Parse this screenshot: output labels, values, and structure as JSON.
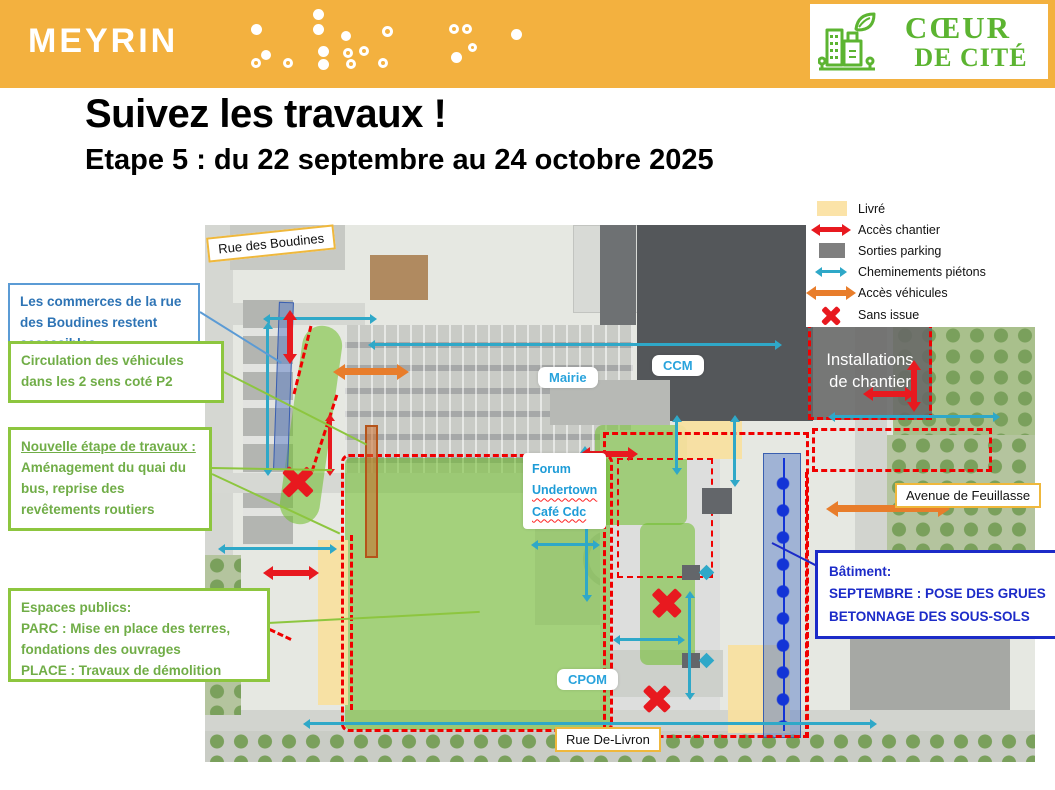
{
  "banner": {
    "brand": "MEYRIN",
    "logo": {
      "line1": "CŒUR",
      "line2": "DE CITÉ",
      "icon": "green-city-leaf-icon"
    }
  },
  "header": {
    "title": "Suivez les travaux !",
    "subtitle": "Etape 5 : du 22 septembre au 24 octobre 2025"
  },
  "legend": {
    "items": [
      {
        "label": "Livré",
        "icon": "yellow-area-swatch"
      },
      {
        "label": "Accès chantier",
        "icon": "red-double-arrow"
      },
      {
        "label": "Sorties parking",
        "icon": "gray-area-swatch"
      },
      {
        "label": "Cheminements piétons",
        "icon": "cyan-double-arrow"
      },
      {
        "label": "Accès véhicules",
        "icon": "orange-double-arrow"
      },
      {
        "label": "Sans issue",
        "icon": "red-x"
      }
    ]
  },
  "callouts": {
    "commerces": {
      "text": "Les commerces de la rue des Boudines restent accessibles"
    },
    "circulation": {
      "text": "Circulation des véhicules dans les 2 sens coté P2"
    },
    "nouvelle_etape": {
      "title": "Nouvelle étape de travaux :",
      "body": "Aménagement du quai du bus, reprise des revêtements routiers"
    },
    "espaces_publics": {
      "line1": "Espaces publics:",
      "line2": "PARC : Mise en place des terres, fondations des ouvrages",
      "line3": "PLACE : Travaux de démolition"
    },
    "batiment": {
      "line1": "Bâtiment:",
      "line2": "SEPTEMBRE : POSE DES GRUES",
      "line3": "BETONNAGE DES SOUS-SOLS"
    }
  },
  "map": {
    "labels": {
      "rue_des_boudines": "Rue des Boudines",
      "mairie": "Mairie",
      "ccm": "CCM",
      "forum_line1": "Forum",
      "forum_line2": "Undertown",
      "forum_line3": "Café Cdc",
      "installations_line1": "Installations",
      "installations_line2": "de chantier",
      "avenue_de_feuillasse": "Avenue de Feuillasse",
      "cpom": "CPOM",
      "rue_de_livron": "Rue De-Livron"
    }
  },
  "colors": {
    "banner_orange": "#F3B13F",
    "logo_green": "#5CB431",
    "legend_yellow": "#FBE3A8",
    "swatch_gray": "#7F7F7F",
    "arrow_red": "#E8191F",
    "arrow_cyan": "#2FA8C8",
    "arrow_orange": "#E87D2B",
    "dash_red": "#F00000",
    "zone_green": "#6EBE28",
    "zone_yellow": "#F8DF9E",
    "strip_blue": "#5A7DC8",
    "green_text": "#70AD47",
    "green_border": "#8DC63F",
    "blue_text": "#2E74B5",
    "batiment_blue": "#1C2BC8",
    "label_cyan": "#29A3DC"
  }
}
